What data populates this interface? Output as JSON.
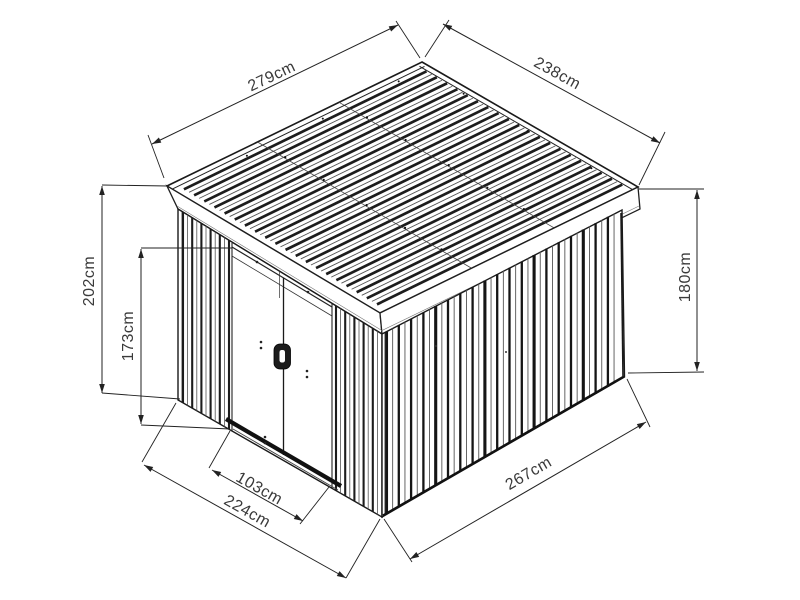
{
  "figure": {
    "dimensions": {
      "roof_front_edge": "279cm",
      "roof_side_edge": "238cm",
      "left_corner_height": "202cm",
      "door_height": "173cm",
      "rear_corner_height": "180cm",
      "door_width": "103cm",
      "front_base_width": "224cm",
      "side_base_depth": "267cm"
    }
  }
}
